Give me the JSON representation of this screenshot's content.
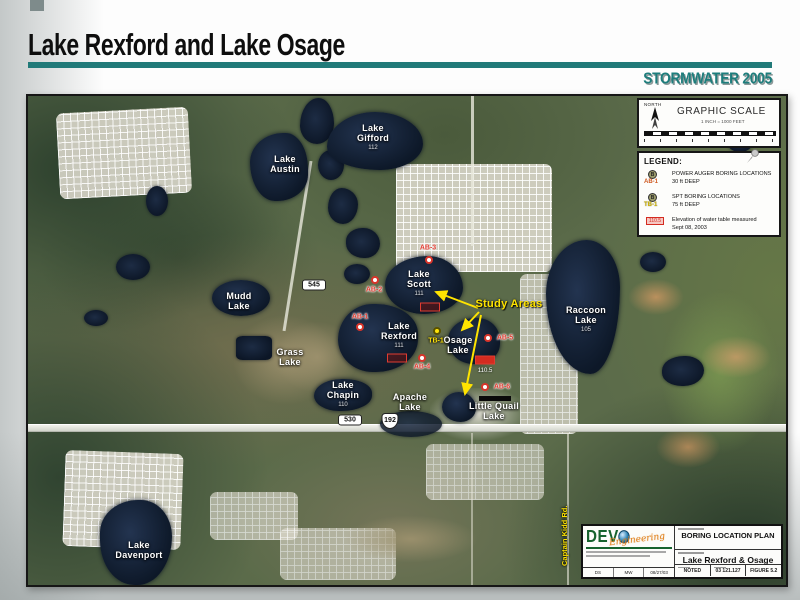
{
  "slide": {
    "title": "Lake Rexford and Lake Osage",
    "banner": "STORMWATER 2005",
    "accent_color": "#217a79"
  },
  "scale_box": {
    "north": "NORTH",
    "title": "GRAPHIC SCALE",
    "ratio": "1 INCH = 1000 FEET"
  },
  "legend": {
    "title": "LEGEND:",
    "auger": {
      "id": "AB-1",
      "line1": "POWER AUGER BORING LOCATIONS",
      "line2": "30 ft DEEP"
    },
    "spt": {
      "id": "TB-1",
      "line1": "SPT BORING LOCATIONS",
      "line2": "75 ft DEEP"
    },
    "elevation": {
      "sample": "110.5",
      "line1": "Elevation of water table measured",
      "line2": "Sept 08, 2003"
    }
  },
  "map": {
    "study_areas": "Study Areas",
    "street": "Captain Kidd Rd.",
    "routes": {
      "r545": "545",
      "r530": "530",
      "r192": "192"
    },
    "lakes": {
      "austin": {
        "l1": "Lake",
        "l2": "Austin"
      },
      "gifford": {
        "l1": "Lake",
        "l2": "Gifford",
        "elev": "112"
      },
      "mudd": {
        "l1": "Mudd",
        "l2": "Lake"
      },
      "grass": {
        "l1": "Grass",
        "l2": "Lake"
      },
      "scott": {
        "l1": "Lake",
        "l2": "Scott",
        "elev": "111"
      },
      "rexford": {
        "l1": "Lake",
        "l2": "Rexford",
        "elev": "111"
      },
      "osage": {
        "l1": "Osage",
        "l2": "Lake",
        "water_table": "110.5"
      },
      "chapin": {
        "l1": "Lake",
        "l2": "Chapin",
        "elev": "110"
      },
      "apache": {
        "l1": "Apache",
        "l2": "Lake"
      },
      "quail": {
        "l1": "Little Quail",
        "l2": "Lake"
      },
      "raccoon": {
        "l1": "Raccoon",
        "l2": "Lake",
        "elev": "105"
      },
      "davenport": {
        "l1": "Lake",
        "l2": "Davenport"
      }
    },
    "borings": {
      "ab1": "AB-1",
      "ab2": "AB-2",
      "ab3": "AB-3",
      "ab4": "AB-4",
      "ab5": "AB-5",
      "ab6": "AB-6",
      "tb1": "TB-1"
    }
  },
  "title_block": {
    "company": "DEVO",
    "script": "Engineering",
    "figure_name": "BORING LOCATION PLAN",
    "project_name": "Lake Rexford & Osage",
    "scale": "NOTED",
    "project_no": "03 121.127",
    "figure_no": "FIGURE 5.2",
    "drawn": "DS",
    "checked": "MW",
    "date": "08/27/03"
  }
}
